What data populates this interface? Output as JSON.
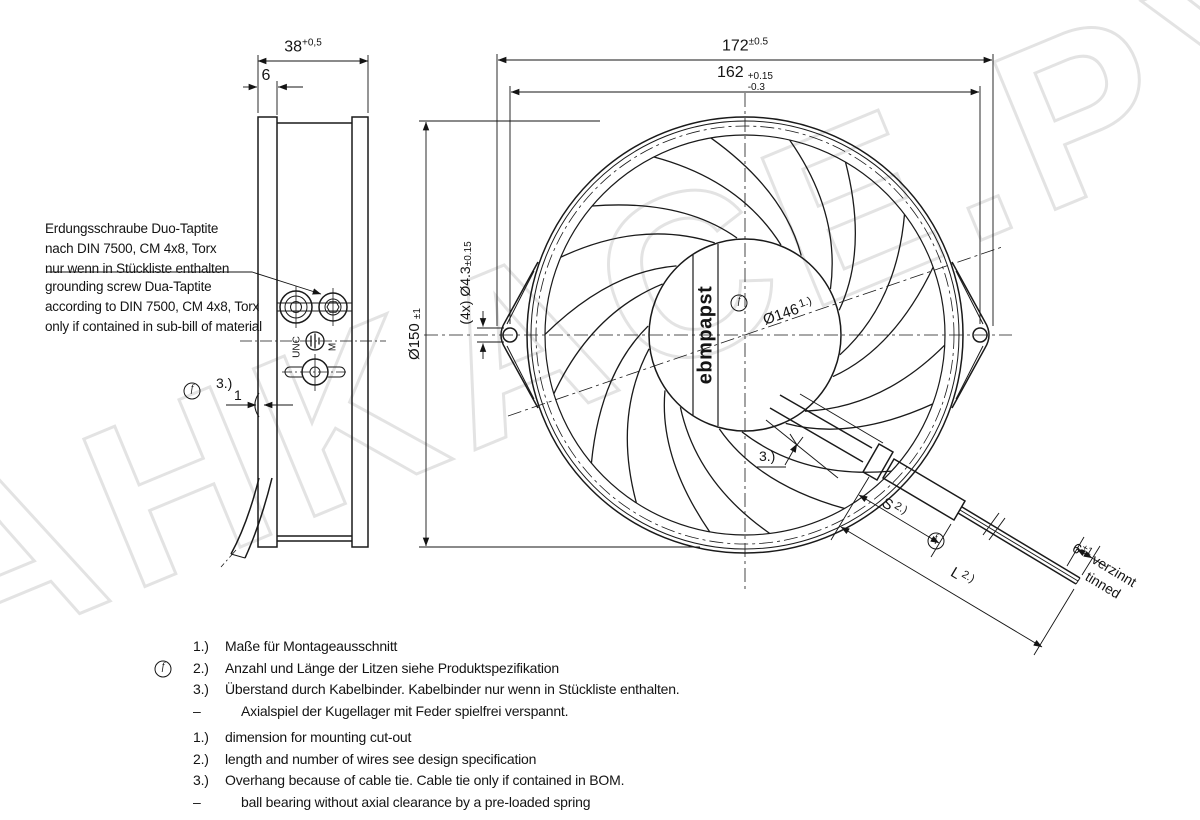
{
  "drawing": {
    "watermark": "AHKACE.PY",
    "logo": "ebmpapst",
    "balloon_f": "f",
    "side_view": {
      "dim_38": {
        "value": "38",
        "tol": "+0,5"
      },
      "dim_6": "6",
      "dim_1": "1",
      "ref_3": "3.)",
      "label_unc": "UNC",
      "label_m": "M",
      "note_de": [
        "Erdungsschraube Duo-Taptite",
        "nach DIN 7500, CM 4x8, Torx",
        "nur wenn in Stückliste enthalten"
      ],
      "note_en": [
        "grounding screw Dua-Taptite",
        "according to DIN 7500, CM 4x8, Torx",
        "only if contained in sub-bill of material"
      ]
    },
    "front_view": {
      "dim_172": {
        "value": "172",
        "tol": "±0.5"
      },
      "dim_162": {
        "value": "162",
        "tol_plus": "+0.15",
        "tol_minus": "-0.3"
      },
      "dim_150": {
        "value": "Ø150",
        "tol": "±1"
      },
      "dim_43": {
        "prefix": "(4x)",
        "value": "Ø4.3",
        "tol": "±0.15"
      },
      "dim_146": {
        "value": "Ø146",
        "ref": "1.)"
      },
      "ref_3": "3.)"
    },
    "cable": {
      "dim_s": {
        "value": "S",
        "ref": "2.)"
      },
      "dim_l": {
        "value": "L",
        "ref": "2.)"
      },
      "dim_tinned": {
        "value": "6",
        "tol": "±1",
        "label_de": "verzinnt",
        "label_en": "tinned"
      }
    },
    "notes_de": [
      {
        "marker": "1.)",
        "text": "Maße für Montageausschnitt"
      },
      {
        "marker": "2.)",
        "text": "Anzahl und Länge der Litzen siehe Produktspezifikation"
      },
      {
        "marker": "3.)",
        "text": "Überstand durch Kabelbinder. Kabelbinder nur wenn in Stückliste enthalten."
      },
      {
        "marker": "–",
        "text": "Axialspiel der Kugellager mit Feder spielfrei verspannt."
      }
    ],
    "notes_en": [
      {
        "marker": "1.)",
        "text": "dimension for mounting cut-out"
      },
      {
        "marker": "2.)",
        "text": "length and  number of wires see design specification"
      },
      {
        "marker": "3.)",
        "text": "Overhang because of cable tie. Cable tie only if contained in BOM."
      },
      {
        "marker": "–",
        "text": "ball bearing without axial clearance by a pre-loaded spring"
      }
    ]
  }
}
